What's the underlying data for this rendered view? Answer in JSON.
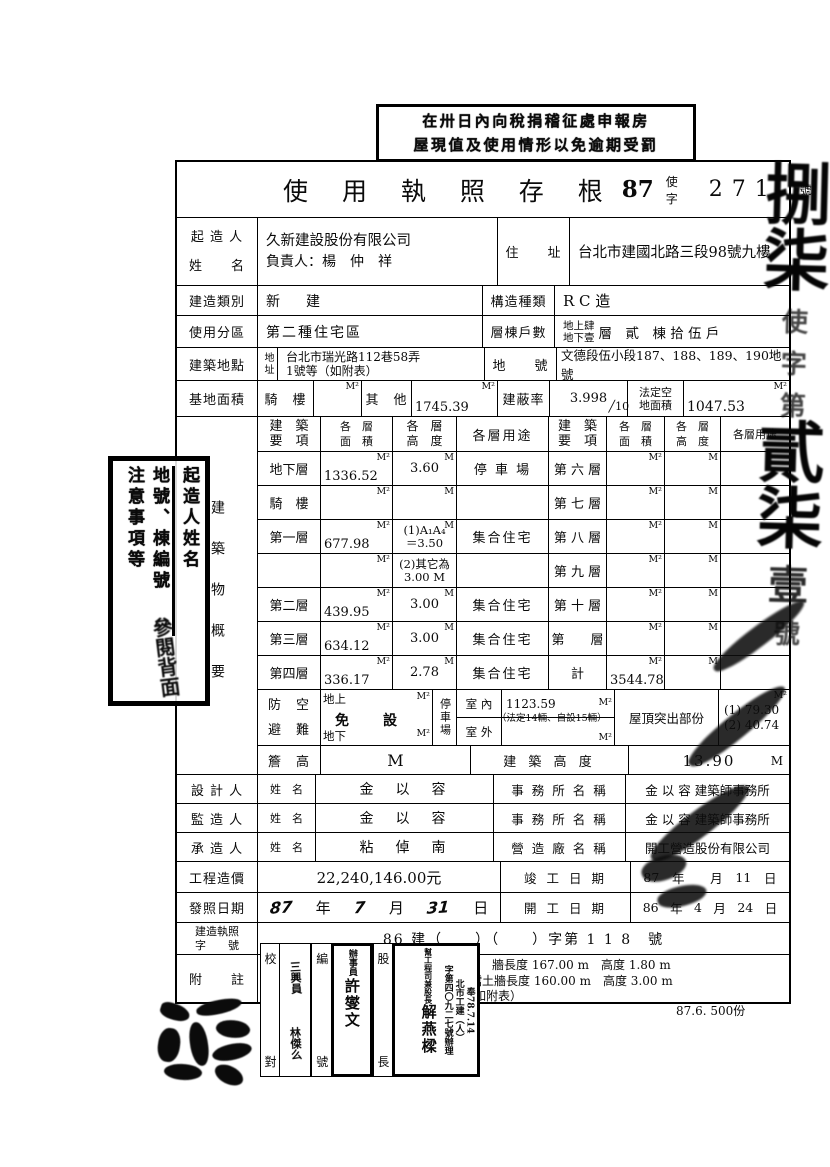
{
  "top_stamp": {
    "line1": "在卅日內向稅捐稽征處申報房",
    "line2": "屋現值及使用情形以免逾期受罰"
  },
  "header": {
    "title": "使 用 執 照 存 根",
    "year": "87",
    "type_label": "使 字",
    "number": "271",
    "suffix": "號"
  },
  "margin": {
    "chars": [
      "捌",
      "柒",
      "使",
      "字",
      "第",
      "貳",
      "柒",
      "壹",
      "號"
    ]
  },
  "owner": {
    "label1": "起 造 人",
    "label2": "姓　　名",
    "company": "久新建設股份有限公司",
    "principal": "負責人：楊　仲　祥",
    "addr_label": "住　　址",
    "address": "台北市建國北路三段98號九樓"
  },
  "build": {
    "label": "建造類別",
    "value": "新　建",
    "kind_label": "構造種類",
    "kind": "R C 造"
  },
  "zone": {
    "label": "使用分區",
    "value": "第二種住宅區",
    "units_label": "層棟戶數",
    "stack1": "地上肆",
    "stack2": "地下壹",
    "units_rest": "層　貳　棟 拾 伍 戶"
  },
  "site": {
    "label": "建築地點",
    "addr_label": "地址",
    "addr1": "台北市瑞光路112巷58弄",
    "addr2": "1號等（如附表）",
    "lot_label": "地　　號",
    "lot": "文德段伍小段187、188、189、190地號"
  },
  "base": {
    "label": "基地面積",
    "arcade": "騎　樓",
    "other": "其　他",
    "other_value": "1745.39",
    "coverage_label": "建蔽率",
    "coverage": "3.998",
    "coverage_den": "╱10",
    "legal1": "法定空",
    "legal2": "地面積",
    "legal_value": "1047.53"
  },
  "units": {
    "m2": "M²",
    "m": "M"
  },
  "grid": {
    "vlabel": "建築物概要",
    "h_item1": "建　築",
    "h_item2": "要　項",
    "h_area1": "各　層",
    "h_area2": "面　積",
    "h_ht1": "各　層",
    "h_ht2": "高　度",
    "h_use": "各層用途",
    "left": [
      {
        "name": "地下層",
        "area": "1336.52",
        "ht": "3.60",
        "ht2": "",
        "use": "停 車 場"
      },
      {
        "name": "騎　樓",
        "area": "",
        "ht": "",
        "ht2": "",
        "use": ""
      },
      {
        "name": "第一層",
        "area": "677.98",
        "ht": "(1)A₁A₄",
        "ht2": "＝3.50",
        "use": "集合住宅"
      },
      {
        "name": "",
        "area": "",
        "ht": "(2)其它為",
        "ht2": "3.00 M",
        "use": ""
      },
      {
        "name": "第二層",
        "area": "439.95",
        "ht": "3.00",
        "ht2": "",
        "use": "集合住宅"
      },
      {
        "name": "第三層",
        "area": "634.12",
        "ht": "3.00",
        "ht2": "",
        "use": "集合住宅"
      },
      {
        "name": "第四層",
        "area": "336.17",
        "ht": "2.78",
        "ht2": "",
        "use": "集合住宅"
      }
    ],
    "right": [
      {
        "name": "第 六 層",
        "area": ""
      },
      {
        "name": "第 七 層",
        "area": ""
      },
      {
        "name": "第 八 層",
        "area": ""
      },
      {
        "name": "第 九 層",
        "area": ""
      },
      {
        "name": "第 十 層",
        "area": ""
      },
      {
        "name": "第　　層",
        "area": ""
      },
      {
        "name": "計",
        "area": "3544.78"
      }
    ]
  },
  "shelter": {
    "label1": "防　空",
    "label2": "避　難",
    "above": "地上",
    "below": "地下",
    "exempt": "免　設",
    "parking": "停車場",
    "indoor": "室 內",
    "indoor_value": "1123.59",
    "capacity": "（法定14輛、自設15輛）",
    "outdoor": "室 外",
    "roof_label": "屋頂突出部份",
    "roof1": "(1) 79.30",
    "roof2": "(2) 40.74"
  },
  "eaves": {
    "label": "簷　高",
    "bh_label": "建 築 高 度",
    "value": "13.90"
  },
  "designer": {
    "label": "設 計 人",
    "name_label": "姓　名",
    "name": "金　以　容",
    "office_label": "事 務 所 名 稱",
    "office": "金 以 容 建築師事務所"
  },
  "supervisor": {
    "label": "監 造 人",
    "name_label": "姓　名",
    "name": "金　以　容",
    "office_label": "事 務 所 名 稱",
    "office": "金 以 容 建築師事務所"
  },
  "contractor": {
    "label": "承 造 人",
    "name_label": "姓　名",
    "name": "粘　倬　南",
    "office_label": "營 造 廠 名 稱",
    "office": "開工營造股份有限公司"
  },
  "cost": {
    "label": "工程造價",
    "value": "22,240,146.00元",
    "done_label": "竣 工 日 期",
    "done_year": "87",
    "done_month": "",
    "done_day": "11"
  },
  "issue": {
    "label": "發照日期",
    "year": "87",
    "month": "7",
    "day": "31",
    "open_label": "開 工 日 期",
    "open_year": "86",
    "open_month": "4",
    "open_day": "24"
  },
  "chars": {
    "year": "年",
    "month": "月",
    "day": "日"
  },
  "permit": {
    "label1": "建造執照",
    "label2": "字　　號",
    "value": "86 建（　　）（　　）字第 1 1 8　號"
  },
  "notes": {
    "label": "附　　註",
    "check1": "校",
    "check2": "對",
    "serial1": "編",
    "serial2": "號",
    "chief1": "股",
    "chief2": "長",
    "sig_top": "三興員",
    "sig_bottom": "林傑么",
    "clerk_title": "辦事員",
    "clerk_name": "許燮文",
    "ref1": "奉78.7.14",
    "ref2": "北市工建（人）",
    "ref3": "字第四〇九二七號辦理",
    "approver_title": "幫工程司兼股長",
    "approver_name": "解燕樑"
  },
  "misc": {
    "label": "雜項內容：",
    "line1": "圍　牆長度 167.00 m　高度 1.80 m",
    "line2": "擋土牆長度 160.00 m　高度 3.00 m",
    "caution": "注意事項：（如附表）",
    "print_note": "87.6. 500份"
  },
  "left_stamp": {
    "col1": "起造人姓名",
    "col2": "地號、棟編號",
    "col3": "注意事項等",
    "hand": "參閱背面"
  }
}
